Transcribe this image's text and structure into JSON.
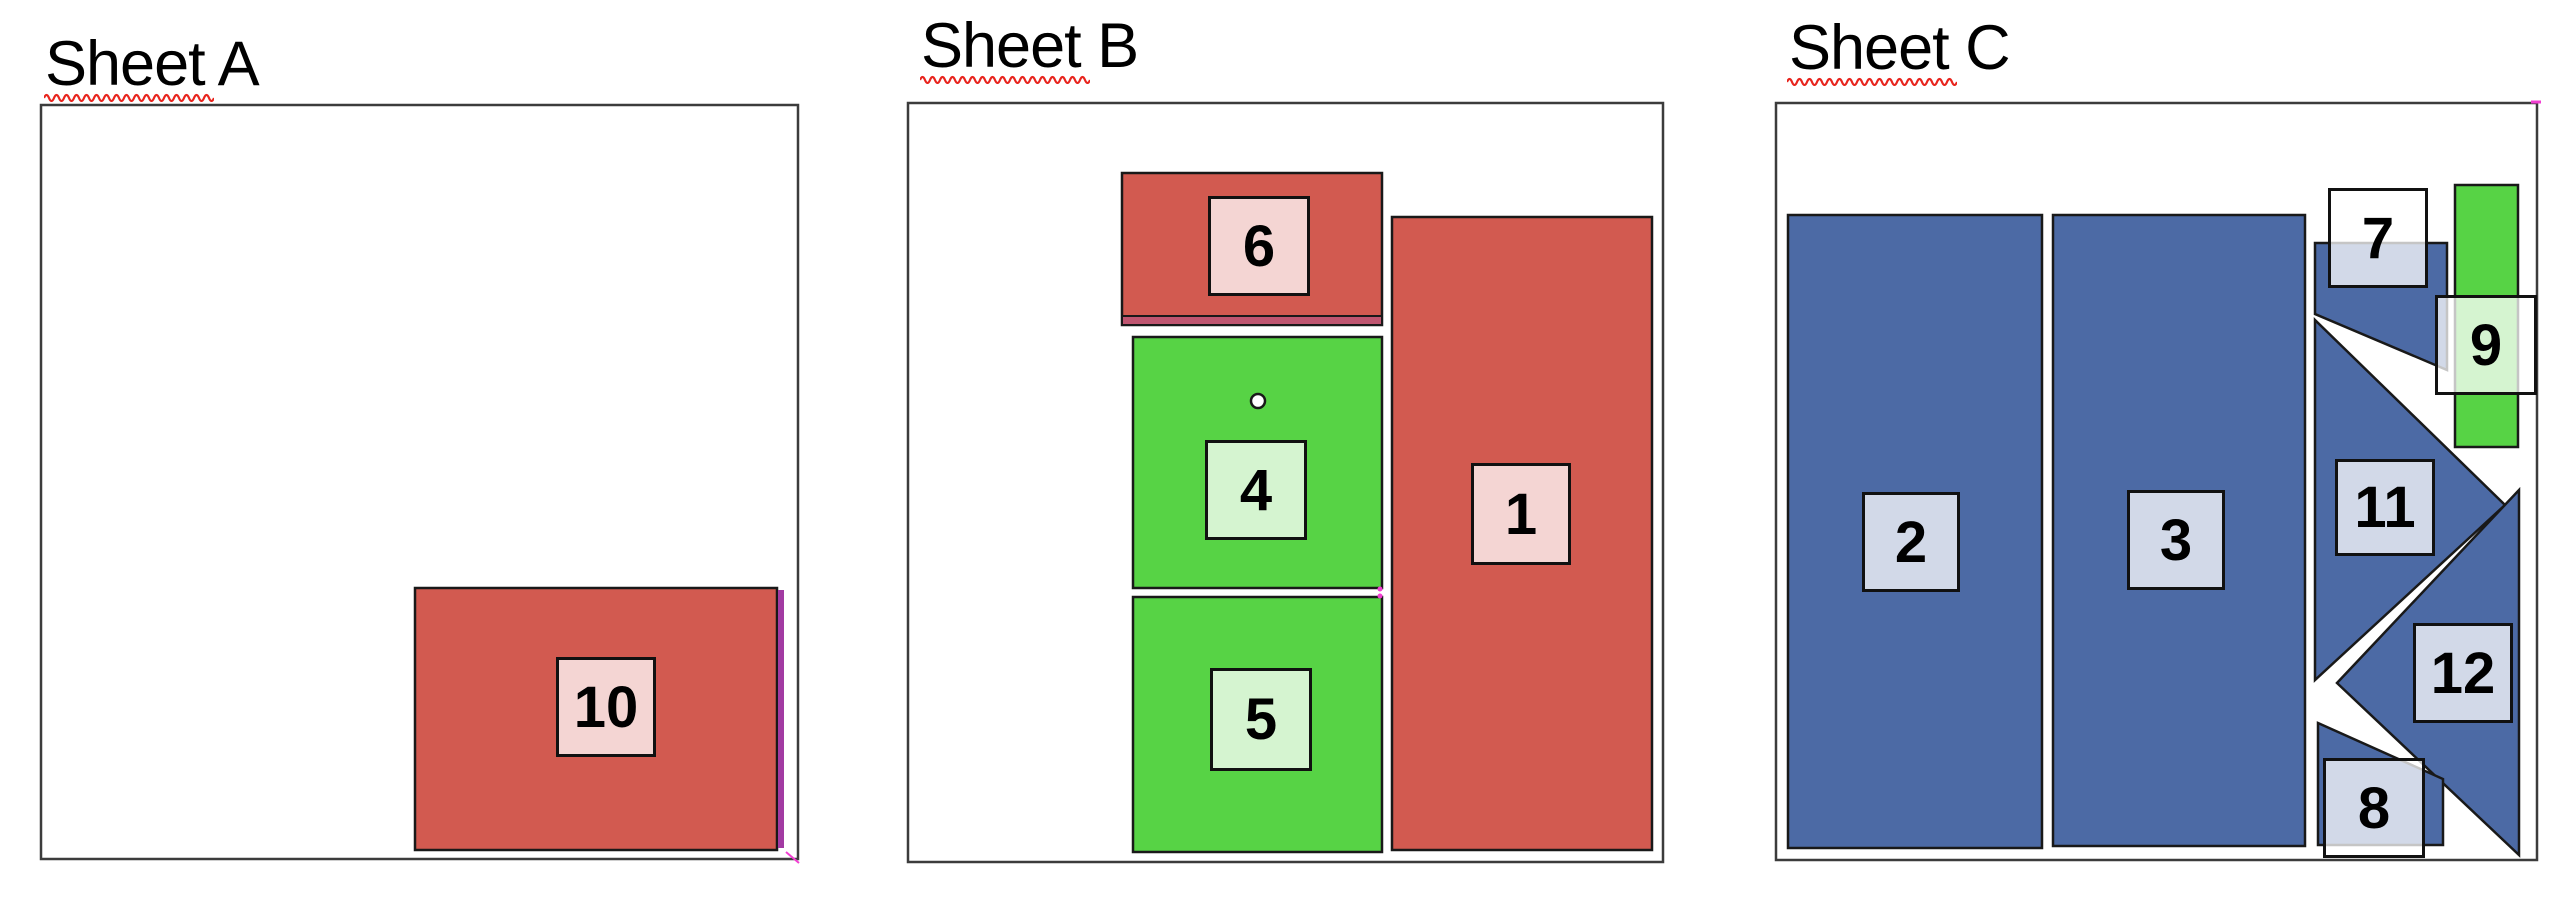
{
  "diagram": {
    "background": "#ffffff",
    "sheet_fill": "#ffffff",
    "sheet_stroke": "#3c3c3c",
    "part_stroke": "#191919",
    "label_border": "#111111",
    "label_fill_opacity": 0.75,
    "squiggle_color": "#e8241d",
    "magenta_accent": "#f23ed2",
    "part_colors": {
      "red": "#d25a50",
      "green": "#57d345",
      "blue": "#4c6aa5"
    }
  },
  "sheets": [
    {
      "title": "Sheet A",
      "title_pos": {
        "x": 45,
        "y": 33
      },
      "squiggle": {
        "x": 44,
        "y": 92,
        "w": 170
      },
      "rect": {
        "x": 41,
        "y": 105,
        "w": 757,
        "h": 754
      },
      "parts": [
        {
          "id": "10",
          "color": "red",
          "shape": "rect",
          "x": 415,
          "y": 588,
          "w": 362,
          "h": 262,
          "label": {
            "x": 556,
            "y": 657,
            "w": 100,
            "h": 100
          }
        }
      ],
      "decor": [
        {
          "type": "rect",
          "x": 778,
          "y": 590,
          "w": 6,
          "h": 258,
          "fill": "#a23aa2"
        },
        {
          "type": "line",
          "x1": 786,
          "y1": 852,
          "x2": 799,
          "y2": 863,
          "stroke": "#f23ed2",
          "w": 2
        }
      ]
    },
    {
      "title": "Sheet B",
      "title_pos": {
        "x": 921,
        "y": 15
      },
      "squiggle": {
        "x": 920,
        "y": 74,
        "w": 170
      },
      "rect": {
        "x": 908,
        "y": 103,
        "w": 755,
        "h": 759
      },
      "parts": [
        {
          "id": "6",
          "color": "red",
          "shape": "rect",
          "x": 1122,
          "y": 173,
          "w": 260,
          "h": 152,
          "label": {
            "x": 1208,
            "y": 196,
            "w": 102,
            "h": 100
          }
        },
        {
          "id": "4",
          "color": "green",
          "shape": "rect",
          "x": 1133,
          "y": 337,
          "w": 249,
          "h": 251,
          "hole": {
            "cx": 1258,
            "cy": 401,
            "r": 7
          },
          "label": {
            "x": 1205,
            "y": 440,
            "w": 102,
            "h": 100
          }
        },
        {
          "id": "5",
          "color": "green",
          "shape": "rect",
          "x": 1133,
          "y": 597,
          "w": 249,
          "h": 255,
          "label": {
            "x": 1210,
            "y": 668,
            "w": 102,
            "h": 103
          }
        },
        {
          "id": "1",
          "color": "red",
          "shape": "rect",
          "x": 1392,
          "y": 217,
          "w": 260,
          "h": 633,
          "label": {
            "x": 1471,
            "y": 463,
            "w": 100,
            "h": 102
          }
        }
      ],
      "decor": [
        {
          "type": "rect",
          "x": 1123,
          "y": 317,
          "w": 258,
          "h": 7,
          "fill": "#bf5570"
        },
        {
          "type": "line",
          "x1": 1122,
          "y1": 316,
          "x2": 1382,
          "y2": 316,
          "stroke": "#191919",
          "w": 2
        },
        {
          "type": "dot",
          "cx": 1380,
          "cy": 589,
          "r": 2.5,
          "fill": "#f23ed2"
        },
        {
          "type": "dot",
          "cx": 1380,
          "cy": 596,
          "r": 2.5,
          "fill": "#f23ed2"
        }
      ]
    },
    {
      "title": "Sheet C",
      "title_pos": {
        "x": 1789,
        "y": 17
      },
      "squiggle": {
        "x": 1787,
        "y": 76,
        "w": 170
      },
      "rect": {
        "x": 1776,
        "y": 103,
        "w": 761,
        "h": 757
      },
      "parts": [
        {
          "id": "2",
          "color": "blue",
          "shape": "rect",
          "x": 1788,
          "y": 215,
          "w": 254,
          "h": 633,
          "label": {
            "x": 1862,
            "y": 492,
            "w": 98,
            "h": 100
          }
        },
        {
          "id": "3",
          "color": "blue",
          "shape": "rect",
          "x": 2053,
          "y": 215,
          "w": 252,
          "h": 631,
          "label": {
            "x": 2127,
            "y": 490,
            "w": 98,
            "h": 100
          }
        },
        {
          "id": "7",
          "color": "blue",
          "shape": "polygon",
          "points": [
            [
              2315,
              243
            ],
            [
              2447,
              243
            ],
            [
              2447,
              370
            ],
            [
              2315,
              314
            ]
          ],
          "label": {
            "x": 2328,
            "y": 188,
            "w": 100,
            "h": 100
          }
        },
        {
          "id": "9",
          "color": "green",
          "shape": "rect",
          "x": 2455,
          "y": 185,
          "w": 63,
          "h": 262,
          "label": {
            "x": 2435,
            "y": 295,
            "w": 102,
            "h": 100
          }
        },
        {
          "id": "11",
          "color": "blue",
          "shape": "polygon",
          "points": [
            [
              2315,
              320
            ],
            [
              2505,
              505
            ],
            [
              2315,
              680
            ]
          ],
          "label": {
            "x": 2335,
            "y": 459,
            "w": 100,
            "h": 97
          }
        },
        {
          "id": "12",
          "color": "blue",
          "shape": "polygon",
          "points": [
            [
              2519,
              490
            ],
            [
              2519,
              855
            ],
            [
              2337,
              683
            ]
          ],
          "label": {
            "x": 2413,
            "y": 623,
            "w": 100,
            "h": 100
          }
        },
        {
          "id": "8",
          "color": "blue",
          "shape": "polygon",
          "points": [
            [
              2318,
              723
            ],
            [
              2443,
              779
            ],
            [
              2443,
              845
            ],
            [
              2318,
              845
            ]
          ],
          "label": {
            "x": 2323,
            "y": 758,
            "w": 102,
            "h": 100
          }
        }
      ],
      "decor": [
        {
          "type": "line",
          "x1": 2531,
          "y1": 102,
          "x2": 2541,
          "y2": 102,
          "stroke": "#f23ed2",
          "w": 3
        }
      ]
    }
  ]
}
